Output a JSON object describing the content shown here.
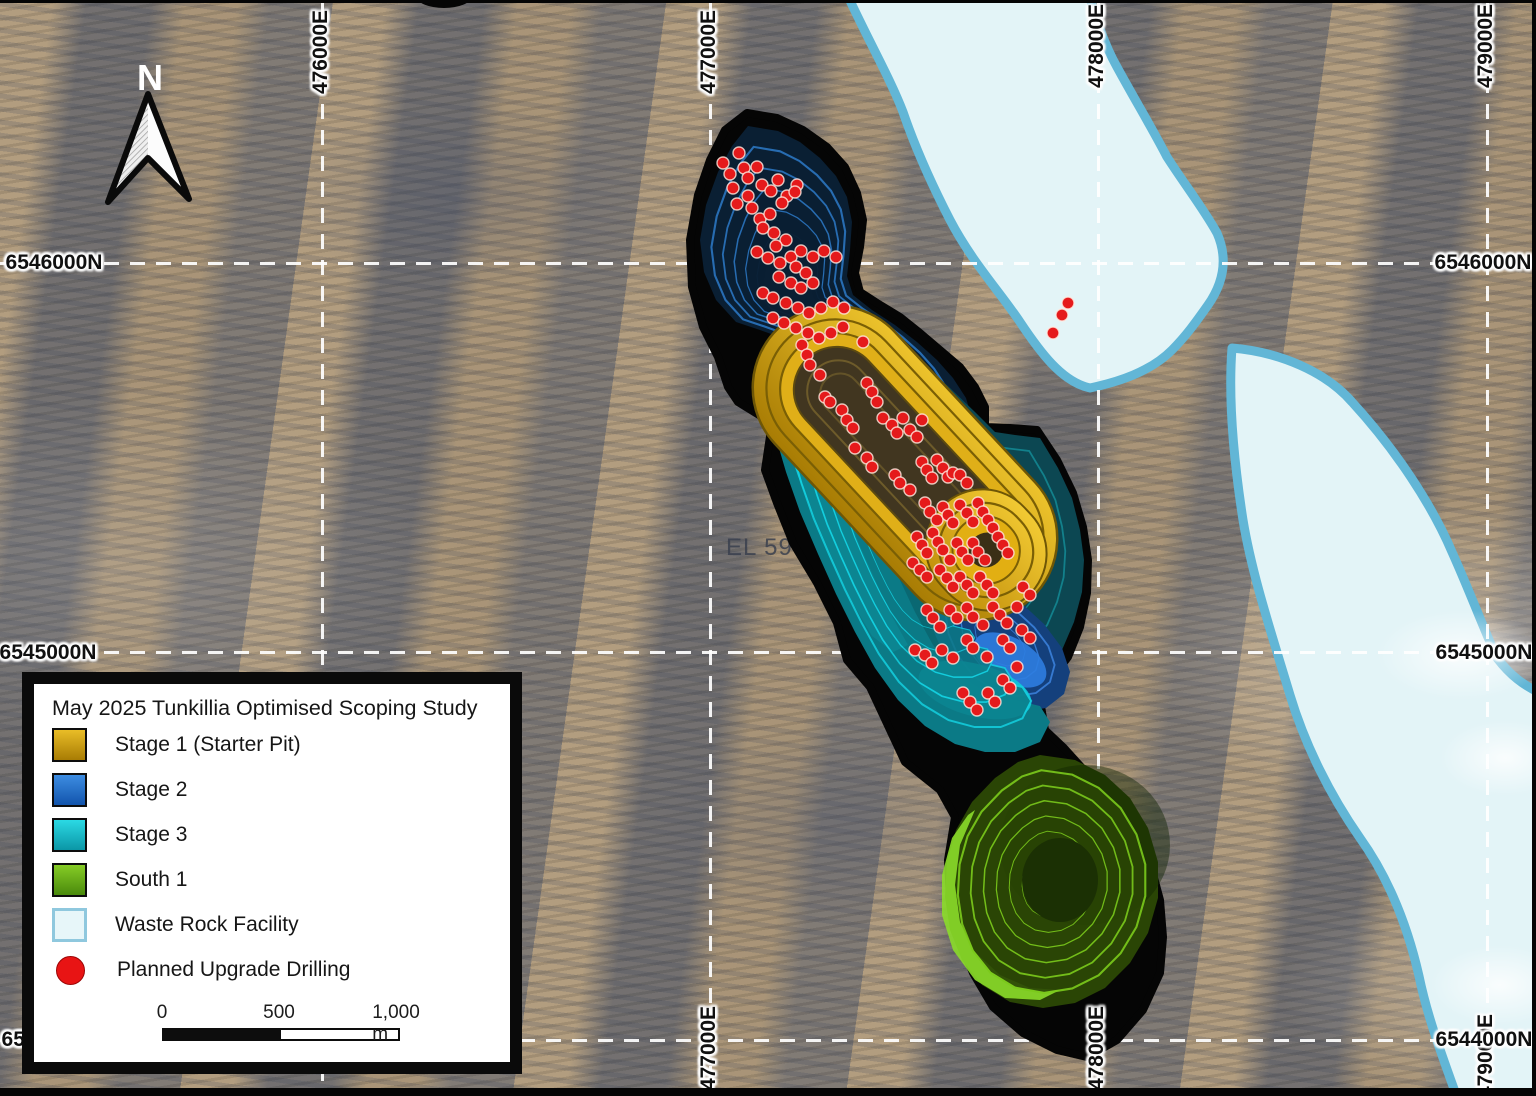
{
  "map": {
    "north_label": "N",
    "tenement_label": "EL 5901",
    "grid": {
      "eastings_top": [
        "476000E",
        "477000E",
        "478000E",
        "479000E"
      ],
      "eastings_bottom": [
        "477000E",
        "478000E",
        "479000E"
      ],
      "northings_left": [
        "6546000N",
        "6545000N",
        "6544000N"
      ],
      "northings_right": [
        "6546000N",
        "6545000N",
        "6544000N"
      ]
    },
    "colors": {
      "stage1_gold": "#d9a81e",
      "stage2_blue": "#2e7fd9",
      "stage3_cyan": "#14d0e0",
      "south1_green": "#7ccb1d",
      "waste_rock_fill": "#e3f4f7",
      "waste_rock_border": "#62b6d6",
      "drill_red": "#e51a1b",
      "pit_outline": "#050505",
      "grid_white": "#ffffff"
    },
    "drill_points": [
      [
        723,
        163
      ],
      [
        739,
        153
      ],
      [
        730,
        174
      ],
      [
        744,
        168
      ],
      [
        757,
        167
      ],
      [
        748,
        178
      ],
      [
        733,
        188
      ],
      [
        762,
        185
      ],
      [
        748,
        196
      ],
      [
        771,
        191
      ],
      [
        778,
        180
      ],
      [
        797,
        185
      ],
      [
        787,
        196
      ],
      [
        737,
        204
      ],
      [
        752,
        208
      ],
      [
        760,
        219
      ],
      [
        770,
        214
      ],
      [
        782,
        203
      ],
      [
        795,
        192
      ],
      [
        763,
        228
      ],
      [
        774,
        233
      ],
      [
        786,
        240
      ],
      [
        776,
        246
      ],
      [
        757,
        252
      ],
      [
        768,
        258
      ],
      [
        780,
        263
      ],
      [
        791,
        257
      ],
      [
        801,
        251
      ],
      [
        813,
        257
      ],
      [
        824,
        251
      ],
      [
        836,
        257
      ],
      [
        796,
        267
      ],
      [
        806,
        273
      ],
      [
        779,
        277
      ],
      [
        791,
        283
      ],
      [
        801,
        288
      ],
      [
        813,
        283
      ],
      [
        763,
        293
      ],
      [
        773,
        298
      ],
      [
        786,
        303
      ],
      [
        798,
        308
      ],
      [
        809,
        313
      ],
      [
        821,
        308
      ],
      [
        833,
        302
      ],
      [
        844,
        308
      ],
      [
        773,
        318
      ],
      [
        784,
        323
      ],
      [
        796,
        328
      ],
      [
        808,
        333
      ],
      [
        819,
        338
      ],
      [
        831,
        333
      ],
      [
        843,
        327
      ],
      [
        1053,
        333
      ],
      [
        1062,
        315
      ],
      [
        1068,
        303
      ],
      [
        863,
        342
      ],
      [
        802,
        345
      ],
      [
        807,
        355
      ],
      [
        810,
        365
      ],
      [
        820,
        375
      ],
      [
        825,
        397
      ],
      [
        830,
        402
      ],
      [
        842,
        410
      ],
      [
        847,
        420
      ],
      [
        853,
        428
      ],
      [
        855,
        448
      ],
      [
        867,
        458
      ],
      [
        872,
        467
      ],
      [
        867,
        383
      ],
      [
        872,
        392
      ],
      [
        877,
        402
      ],
      [
        883,
        418
      ],
      [
        892,
        425
      ],
      [
        897,
        433
      ],
      [
        903,
        418
      ],
      [
        910,
        430
      ],
      [
        917,
        437
      ],
      [
        922,
        420
      ],
      [
        895,
        475
      ],
      [
        900,
        483
      ],
      [
        910,
        490
      ],
      [
        922,
        462
      ],
      [
        927,
        470
      ],
      [
        932,
        478
      ],
      [
        937,
        460
      ],
      [
        943,
        468
      ],
      [
        948,
        477
      ],
      [
        953,
        473
      ],
      [
        960,
        475
      ],
      [
        967,
        483
      ],
      [
        925,
        503
      ],
      [
        930,
        512
      ],
      [
        937,
        520
      ],
      [
        943,
        507
      ],
      [
        948,
        515
      ],
      [
        953,
        523
      ],
      [
        960,
        505
      ],
      [
        967,
        513
      ],
      [
        973,
        522
      ],
      [
        978,
        503
      ],
      [
        983,
        512
      ],
      [
        988,
        520
      ],
      [
        993,
        528
      ],
      [
        917,
        537
      ],
      [
        922,
        545
      ],
      [
        927,
        553
      ],
      [
        933,
        533
      ],
      [
        938,
        542
      ],
      [
        943,
        550
      ],
      [
        950,
        560
      ],
      [
        957,
        543
      ],
      [
        962,
        552
      ],
      [
        968,
        560
      ],
      [
        973,
        543
      ],
      [
        978,
        552
      ],
      [
        985,
        560
      ],
      [
        998,
        537
      ],
      [
        1003,
        545
      ],
      [
        1008,
        553
      ],
      [
        913,
        563
      ],
      [
        920,
        570
      ],
      [
        927,
        577
      ],
      [
        940,
        570
      ],
      [
        947,
        578
      ],
      [
        953,
        587
      ],
      [
        960,
        577
      ],
      [
        967,
        585
      ],
      [
        973,
        593
      ],
      [
        980,
        577
      ],
      [
        987,
        585
      ],
      [
        993,
        593
      ],
      [
        927,
        610
      ],
      [
        933,
        618
      ],
      [
        940,
        627
      ],
      [
        950,
        610
      ],
      [
        957,
        618
      ],
      [
        967,
        608
      ],
      [
        973,
        617
      ],
      [
        983,
        625
      ],
      [
        993,
        607
      ],
      [
        1000,
        615
      ],
      [
        1007,
        623
      ],
      [
        1017,
        607
      ],
      [
        1023,
        587
      ],
      [
        1030,
        595
      ],
      [
        915,
        650
      ],
      [
        925,
        655
      ],
      [
        932,
        663
      ],
      [
        942,
        650
      ],
      [
        953,
        658
      ],
      [
        967,
        640
      ],
      [
        973,
        648
      ],
      [
        987,
        657
      ],
      [
        1003,
        640
      ],
      [
        1010,
        648
      ],
      [
        1022,
        630
      ],
      [
        1030,
        638
      ],
      [
        1003,
        680
      ],
      [
        1010,
        688
      ],
      [
        1017,
        667
      ],
      [
        963,
        693
      ],
      [
        970,
        702
      ],
      [
        977,
        710
      ],
      [
        988,
        693
      ],
      [
        995,
        702
      ]
    ]
  },
  "legend": {
    "title": "May 2025 Tunkillia Optimised Scoping Study",
    "items": [
      {
        "label": "Stage 1 (Starter Pit)"
      },
      {
        "label": "Stage 2"
      },
      {
        "label": "Stage 3"
      },
      {
        "label": "South 1"
      },
      {
        "label": "Waste Rock Facility"
      },
      {
        "label": "Planned Upgrade Drilling"
      }
    ],
    "scalebar": {
      "tick0": "0",
      "tick500": "500",
      "tick1000": "1,000 m"
    }
  }
}
